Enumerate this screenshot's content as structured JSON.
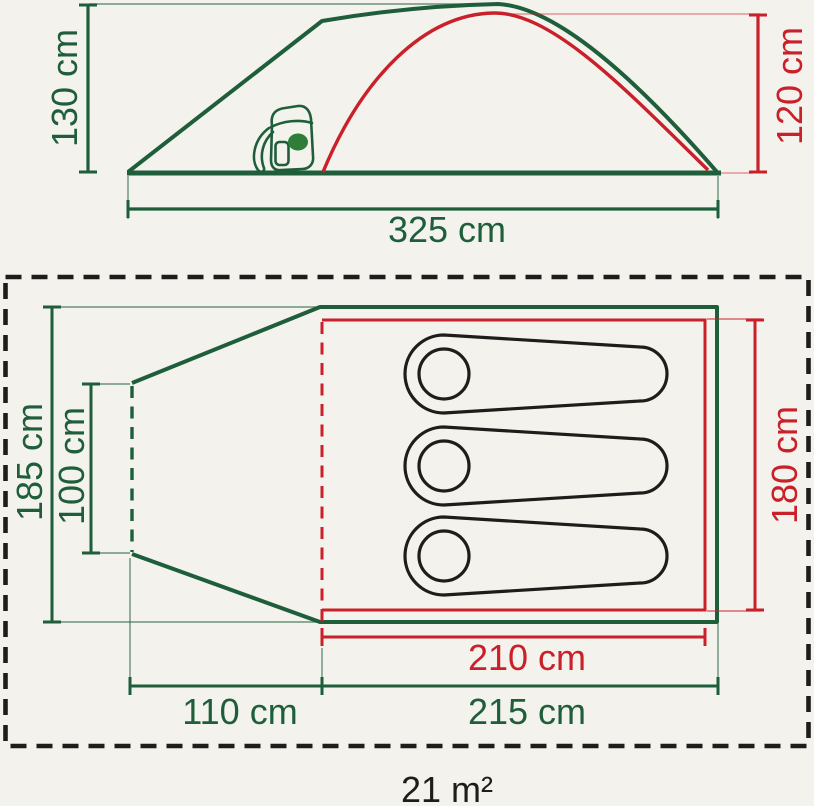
{
  "colors": {
    "background": "#f4f2ec",
    "outer_green": "#1e5e3a",
    "inner_red": "#c9202a",
    "bag_black": "#1d1d1b",
    "backpack_fill_green": "#2e7d39"
  },
  "side_view": {
    "peak_height_label": "130 cm",
    "inner_height_label": "120 cm",
    "length_label": "325 cm"
  },
  "floor_plan": {
    "width_label": "185 cm",
    "door_width_label": "100 cm",
    "inner_width_label": "180 cm",
    "inner_length_label": "210 cm",
    "cabin_length_label": "215 cm",
    "porch_length_label": "110 cm",
    "sleeping_bag_count": 3
  },
  "footprint": {
    "area_label": "21 m²"
  }
}
